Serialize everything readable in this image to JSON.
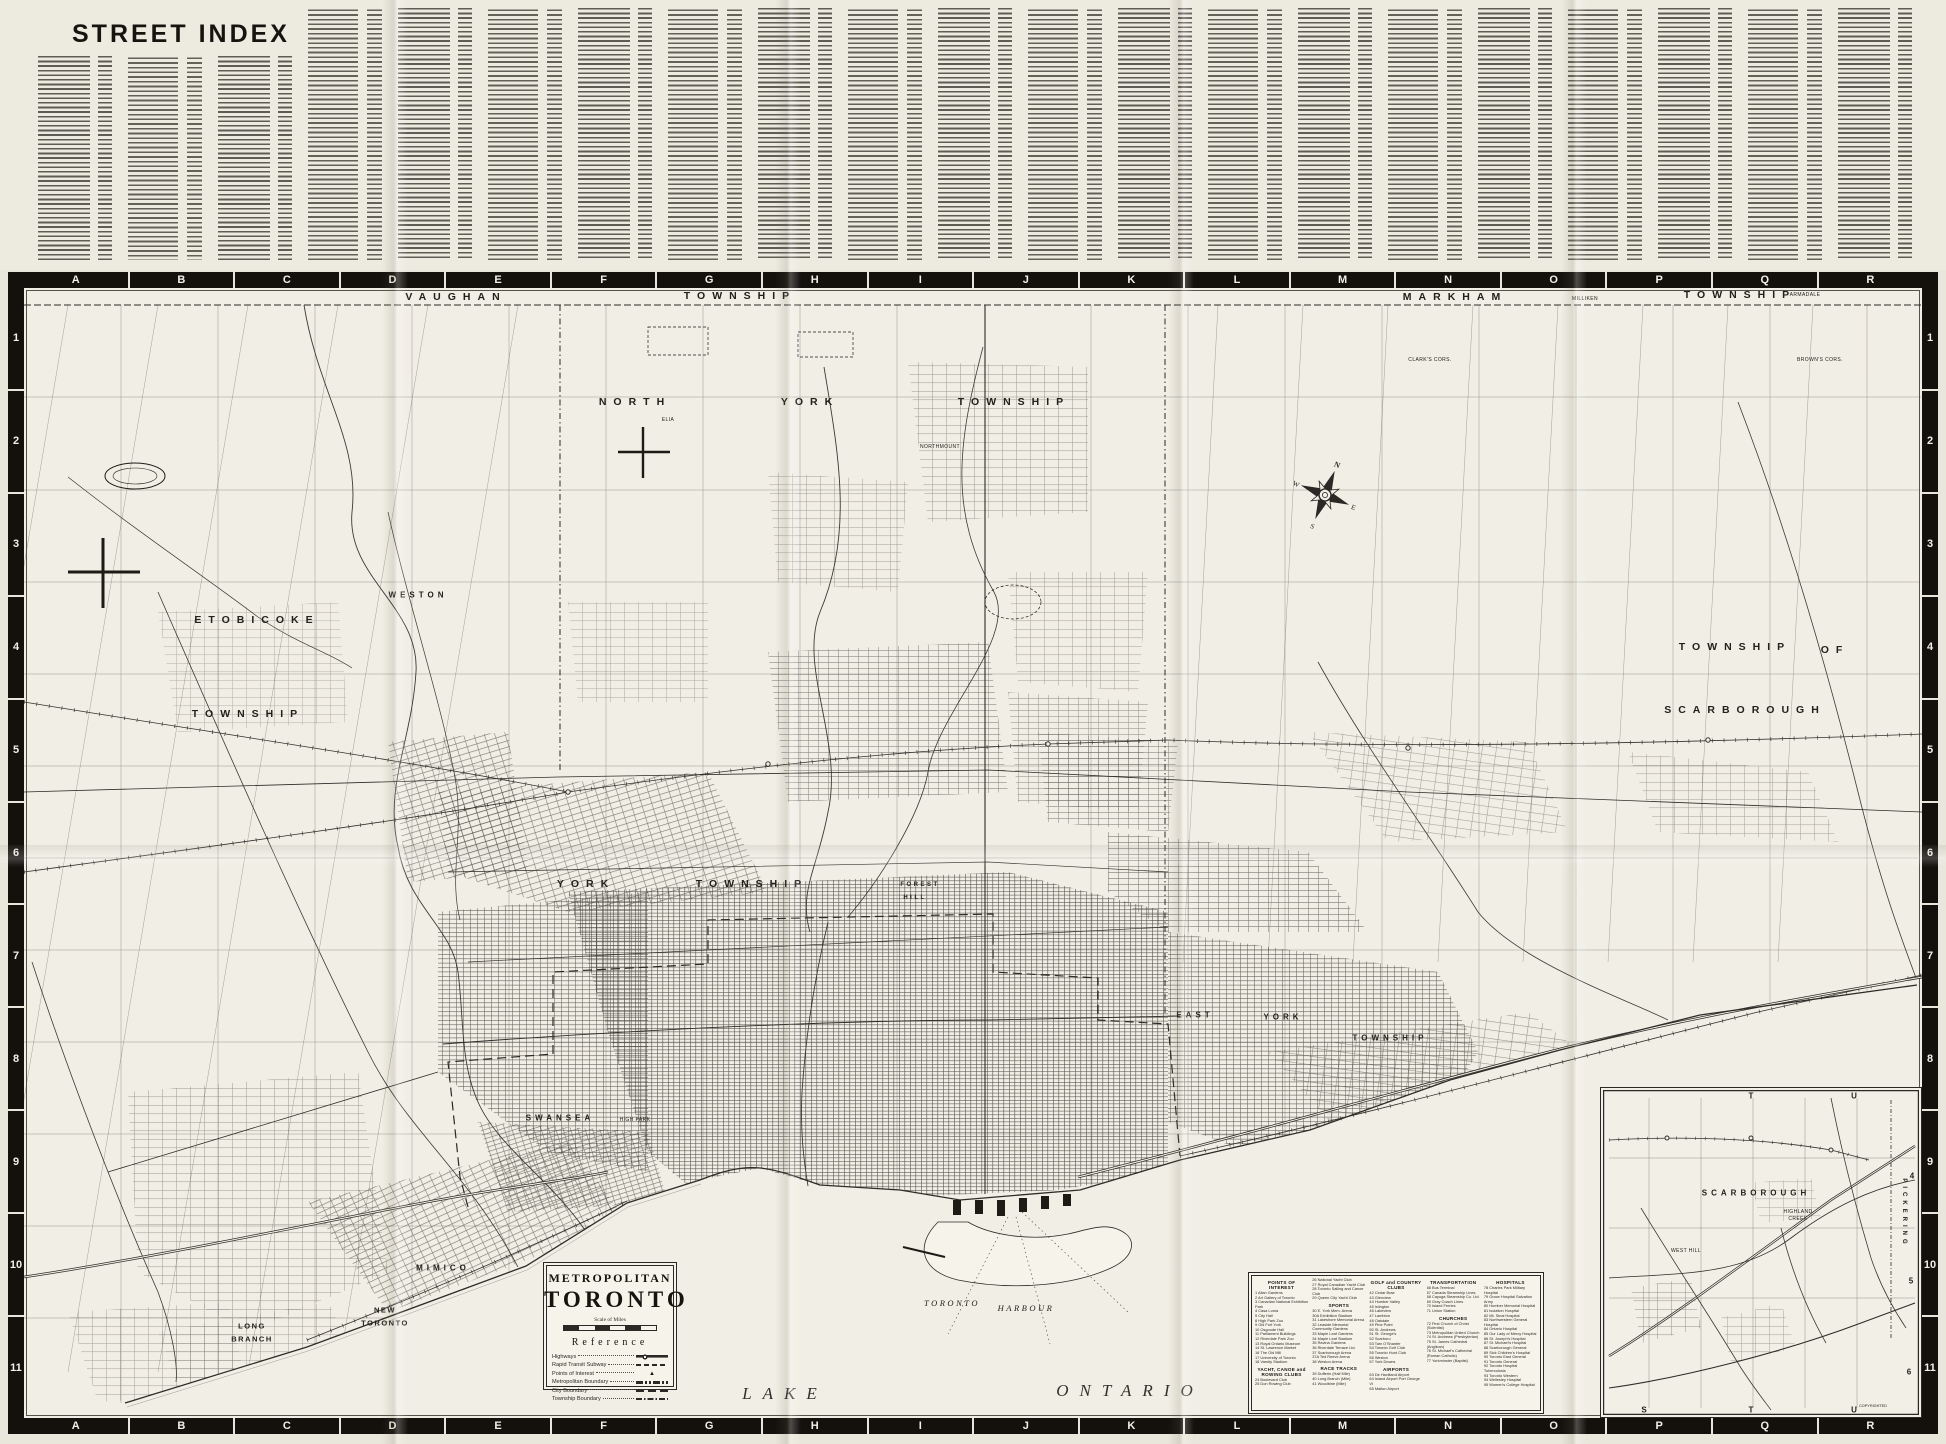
{
  "street_index": {
    "title": "STREET INDEX",
    "column_count": 21
  },
  "colors": {
    "paper": "#f1eee5",
    "index_paper": "#edeae0",
    "ink": "#2b2925",
    "frame_black": "#14110d"
  },
  "map": {
    "grid": {
      "letters": [
        "A",
        "B",
        "C",
        "D",
        "E",
        "F",
        "G",
        "H",
        "I",
        "J",
        "K",
        "L",
        "M",
        "N",
        "O",
        "P",
        "Q",
        "R"
      ],
      "numbers": [
        "1",
        "2",
        "3",
        "4",
        "5",
        "6",
        "7",
        "8",
        "9",
        "10",
        "11"
      ]
    },
    "labels": [
      {
        "t": "VAUGHAN",
        "x": 448,
        "y": 25,
        "c": "town"
      },
      {
        "t": "TOWNSHIP",
        "x": 732,
        "y": 24,
        "c": "town"
      },
      {
        "t": "MARKHAM",
        "x": 1447,
        "y": 25,
        "c": "town"
      },
      {
        "t": "TOWNSHIP",
        "x": 1732,
        "y": 23,
        "c": "town"
      },
      {
        "t": "MILLIKEN",
        "x": 1577,
        "y": 27,
        "c": "tiny"
      },
      {
        "t": "ARMADALE",
        "x": 1797,
        "y": 23,
        "c": "tiny"
      },
      {
        "t": "NORTH",
        "x": 627,
        "y": 130,
        "c": "town"
      },
      {
        "t": "YORK",
        "x": 802,
        "y": 130,
        "c": "town"
      },
      {
        "t": "TOWNSHIP",
        "x": 1006,
        "y": 130,
        "c": "town"
      },
      {
        "t": "ELIA",
        "x": 660,
        "y": 148,
        "c": "tiny"
      },
      {
        "t": "NORTHMOUNT",
        "x": 932,
        "y": 175,
        "c": "tiny"
      },
      {
        "t": "CLARK'S CORS.",
        "x": 1422,
        "y": 88,
        "c": "tiny"
      },
      {
        "t": "BROWN'S CORS.",
        "x": 1812,
        "y": 88,
        "c": "tiny"
      },
      {
        "t": "TOWNSHIP",
        "x": 1727,
        "y": 375,
        "c": "town"
      },
      {
        "t": "OF",
        "x": 1827,
        "y": 378,
        "c": "town"
      },
      {
        "t": "SCARBOROUGH",
        "x": 1737,
        "y": 438,
        "c": "town"
      },
      {
        "t": "ETOBICOKE",
        "x": 249,
        "y": 348,
        "c": "town"
      },
      {
        "t": "TOWNSHIP",
        "x": 240,
        "y": 442,
        "c": "town"
      },
      {
        "t": "WESTON",
        "x": 410,
        "y": 323,
        "c": "area"
      },
      {
        "t": "YORK",
        "x": 578,
        "y": 612,
        "c": "town"
      },
      {
        "t": "TOWNSHIP",
        "x": 744,
        "y": 612,
        "c": "town"
      },
      {
        "t": "FOREST",
        "x": 912,
        "y": 613,
        "c": "sm"
      },
      {
        "t": "HILL",
        "x": 907,
        "y": 626,
        "c": "sm"
      },
      {
        "t": "EAST",
        "x": 1187,
        "y": 743,
        "c": "area"
      },
      {
        "t": "YORK",
        "x": 1275,
        "y": 745,
        "c": "area"
      },
      {
        "t": "TOWNSHIP",
        "x": 1382,
        "y": 766,
        "c": "area"
      },
      {
        "t": "SWANSEA",
        "x": 552,
        "y": 846,
        "c": "area"
      },
      {
        "t": "HIGH PARK",
        "x": 627,
        "y": 848,
        "c": "tiny"
      },
      {
        "t": "MIMICO",
        "x": 435,
        "y": 996,
        "c": "area"
      },
      {
        "t": "NEW",
        "x": 377,
        "y": 1038,
        "c": "area2"
      },
      {
        "t": "TORONTO",
        "x": 377,
        "y": 1051,
        "c": "area2"
      },
      {
        "t": "LONG",
        "x": 244,
        "y": 1054,
        "c": "area2"
      },
      {
        "t": "BRANCH",
        "x": 244,
        "y": 1067,
        "c": "area2"
      },
      {
        "t": "TORONTO",
        "x": 944,
        "y": 1031,
        "c": "water"
      },
      {
        "t": "HARBOUR",
        "x": 1018,
        "y": 1036,
        "c": "water"
      },
      {
        "t": "LAKE",
        "x": 777,
        "y": 1122,
        "c": "lake"
      },
      {
        "t": "ONTARIO",
        "x": 1122,
        "y": 1119,
        "c": "lake"
      }
    ],
    "cartouche": {
      "line1": "METROPOLITAN",
      "line2": "TORONTO",
      "scale_title": "Scale of Miles",
      "reference_title": "Reference",
      "reference_rows": [
        {
          "label": "Highways",
          "symbol": "highway"
        },
        {
          "label": "Rapid Transit Subway",
          "symbol": "subway"
        },
        {
          "label": "Points of Interest",
          "symbol": "poi"
        },
        {
          "label": "Metropolitan Boundary",
          "symbol": "metro"
        },
        {
          "label": "City Boundary",
          "symbol": "city"
        },
        {
          "label": "Township Boundary",
          "symbol": "township"
        }
      ]
    },
    "poi_legend": {
      "columns": [
        [
          {
            "h": "POINTS OF INTEREST",
            "items": [
              "1 Allan Gardens",
              "2 Art Gallery of Toronto",
              "3 Canadian National Exhibition Park",
              "4 Casa Loma",
              "5 City Hall",
              "8 High Park Zoo",
              "9 Old Fort York",
              "10 Osgoode Hall",
              "11 Parliament Buildings",
              "12 Riverdale Park Zoo",
              "13 Royal Ontario Museum",
              "14 St. Lawrence Market",
              "16 The Old Mill",
              "17 University of Toronto",
              "18 Varsity Stadium"
            ]
          },
          {
            "h": "YACHT, CANOE and ROWING CLUBS",
            "items": [
              "24 Boulevard Club",
              "25 Don Rowing Club"
            ]
          }
        ],
        [
          {
            "h": "",
            "items": [
              "26 National Yacht Club",
              "27 Royal Canadian Yacht Club",
              "28 Toronto Sailing and Canoe Club",
              "29 Queen City Yacht Club"
            ]
          },
          {
            "h": "SPORTS",
            "items": [
              "30 E. York Mem. Arena",
              "30A Exhibition Stadium",
              "31 Lakeshore Memorial Arena",
              "32 Leaside Memorial Community Gardens",
              "33 Maple Leaf Gardens",
              "34 Maple Leaf Stadium",
              "35 Ravina Gardens",
              "36 Riverdale Terrace Ltd.",
              "37 Scarborough Arena",
              "37A Ted Reeve Arena",
              "38 Weston Arena"
            ]
          },
          {
            "h": "RACE TRACKS",
            "items": [
              "39 Dufferin (Half Mile)",
              "40 Long Branch (Mile)",
              "41 Woodbine (Mile)"
            ]
          }
        ],
        [
          {
            "h": "GOLF and COUNTRY CLUBS",
            "items": [
              "42 Cedar Brae",
              "43 Glenview",
              "44 Humber Valley",
              "45 Islington",
              "46 Lakeview",
              "47 Lambton",
              "48 Oakdale",
              "49 Pine Point",
              "50 St. Andrews",
              "51 St. George's",
              "52 Scarboro",
              "53 Tam O'Shanter",
              "54 Toronto Golf Club",
              "55 Toronto Hunt Club",
              "56 Weston",
              "57 York Downs"
            ]
          },
          {
            "h": "AIRPORTS",
            "items": [
              "63 De Havilland Airport",
              "64 Island Airport Port George VI",
              "65 Malton Airport"
            ]
          }
        ],
        [
          {
            "h": "TRANSPORTATION",
            "items": [
              "66 Bus Terminal",
              "67 Canada Steamship Lines",
              "68 Cayuga Steamship Co. Ltd.",
              "69 Gray Coach Lines",
              "70 Island Ferries",
              "71 Union Station"
            ]
          },
          {
            "h": "CHURCHES",
            "items": [
              "72 First Church of Christ (Scientist)",
              "73 Metropolitan United Church",
              "74 St. Andrews (Presbyterian)",
              "75 St. James Cathedral (Anglican)",
              "76 St. Michael's Cathedral (Roman Catholic)",
              "77 Yorkminster (Baptist)"
            ]
          }
        ],
        [
          {
            "h": "HOSPITALS",
            "items": [
              "78 Charles Park Military Hospital",
              "79 Grace Hospital Salvation Army",
              "80 Humber Memorial Hospital",
              "81 Isolation Hospital",
              "82 Mt. Sinai Hospital",
              "83 Northwestern General Hospital",
              "84 Ontario Hospital",
              "85 Our Lady of Mercy Hospital",
              "86 St. Joseph's Hospital",
              "87 St. Michael's Hospital",
              "88 Scarborough General",
              "89 Sick Children's Hospital",
              "90 Toronto East General",
              "91 Toronto General",
              "92 Toronto Hospital Tuberculosis",
              "93 Toronto Western",
              "94 Wellesley Hospital",
              "95 Women's College Hospital"
            ]
          }
        ]
      ]
    },
    "inset": {
      "marks": [
        {
          "t": "T",
          "x": 150,
          "y": 8,
          "c": "insetmark"
        },
        {
          "t": "U",
          "x": 253,
          "y": 8,
          "c": "insetmark"
        },
        {
          "t": "S",
          "x": 43,
          "y": 322,
          "c": "insetmark"
        },
        {
          "t": "T",
          "x": 150,
          "y": 322,
          "c": "insetmark"
        },
        {
          "t": "U",
          "x": 253,
          "y": 322,
          "c": "insetmark"
        },
        {
          "t": "4",
          "x": 311,
          "y": 88,
          "c": "insetmark"
        },
        {
          "t": "5",
          "x": 310,
          "y": 193,
          "c": "insetmark"
        },
        {
          "t": "6",
          "x": 308,
          "y": 284,
          "c": "insetmark"
        },
        {
          "t": "SCARBOROUGH",
          "x": 155,
          "y": 105,
          "c": "area"
        },
        {
          "t": "HIGHLAND",
          "x": 197,
          "y": 124,
          "c": "tiny"
        },
        {
          "t": "CREEK",
          "x": 197,
          "y": 131,
          "c": "tiny"
        },
        {
          "t": "WEST HILL",
          "x": 85,
          "y": 163,
          "c": "tiny"
        },
        {
          "t": "PICKERING",
          "x": 303,
          "y": 125,
          "c": "vert"
        },
        {
          "t": "COPYRIGHTED",
          "x": 272,
          "y": 318,
          "c": "copy"
        }
      ]
    }
  }
}
